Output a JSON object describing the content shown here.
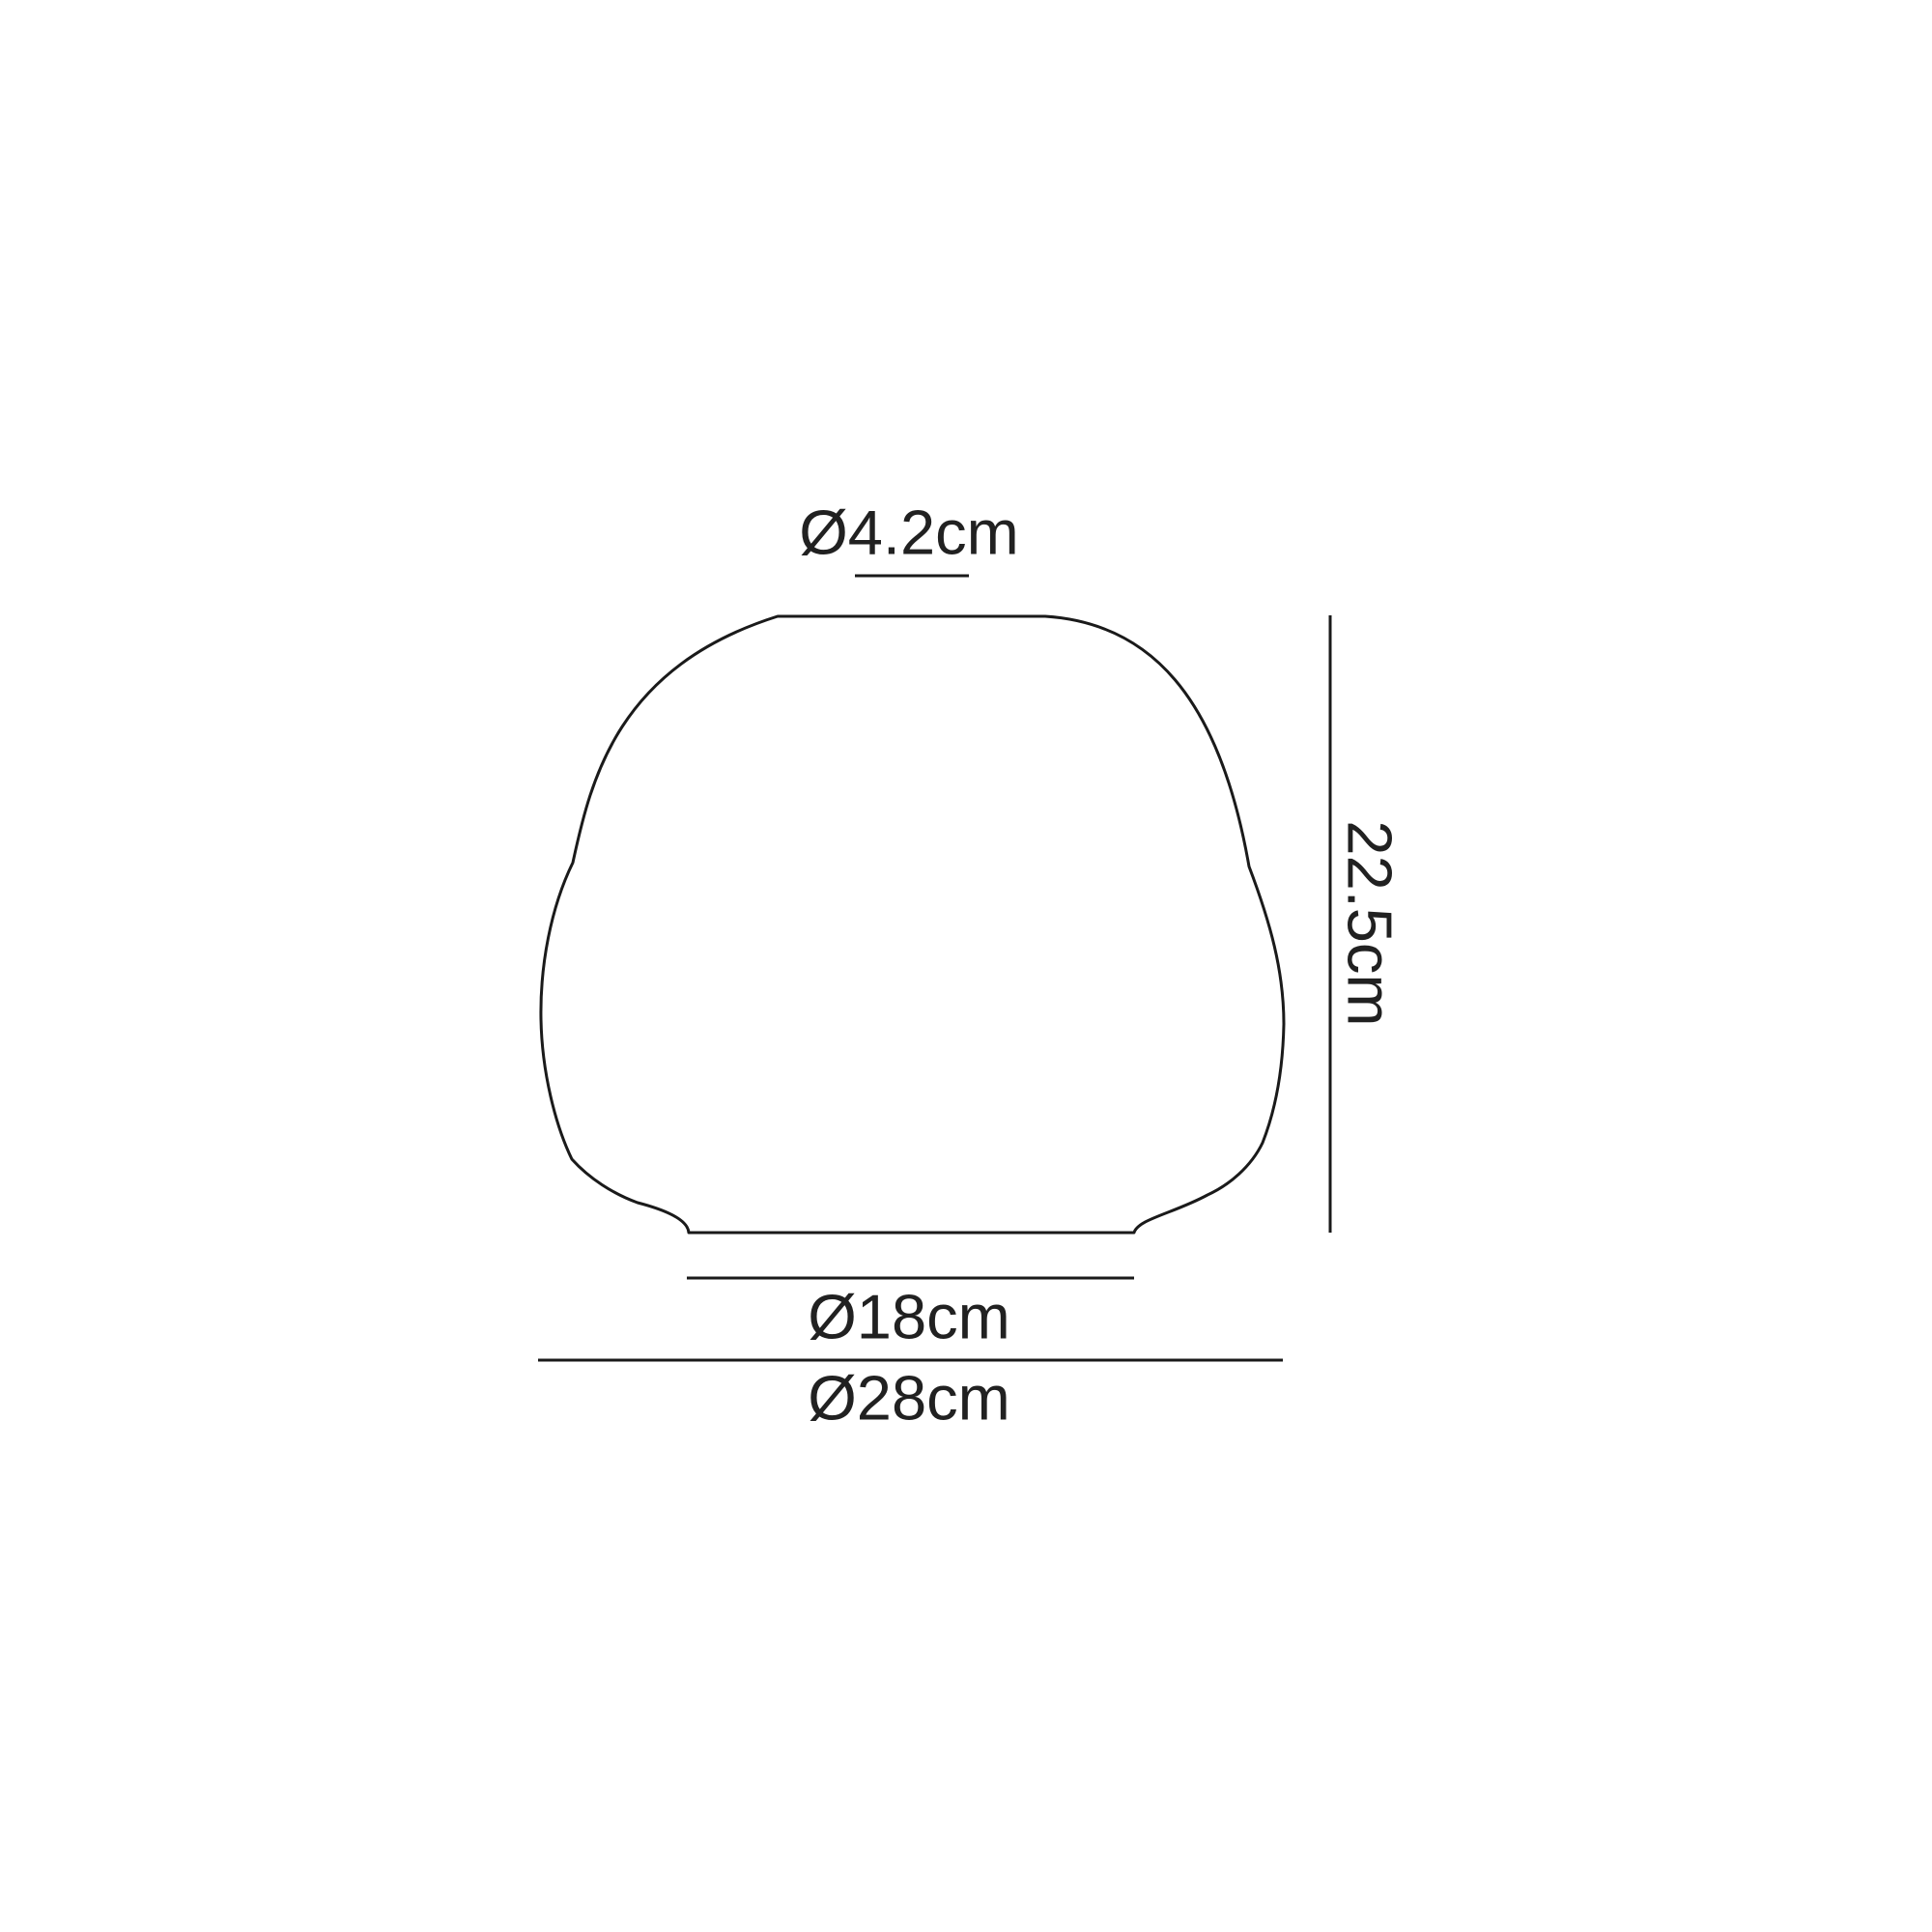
{
  "colors": {
    "background": "#ffffff",
    "line": "#1a1a1a",
    "text": "#212121"
  },
  "diagram": {
    "type": "technical-dimension-drawing",
    "dimensions": {
      "top_diameter": "Ø4.2cm",
      "height": "22.5cm",
      "base_diameter": "Ø18cm",
      "max_diameter": "Ø28cm"
    }
  }
}
